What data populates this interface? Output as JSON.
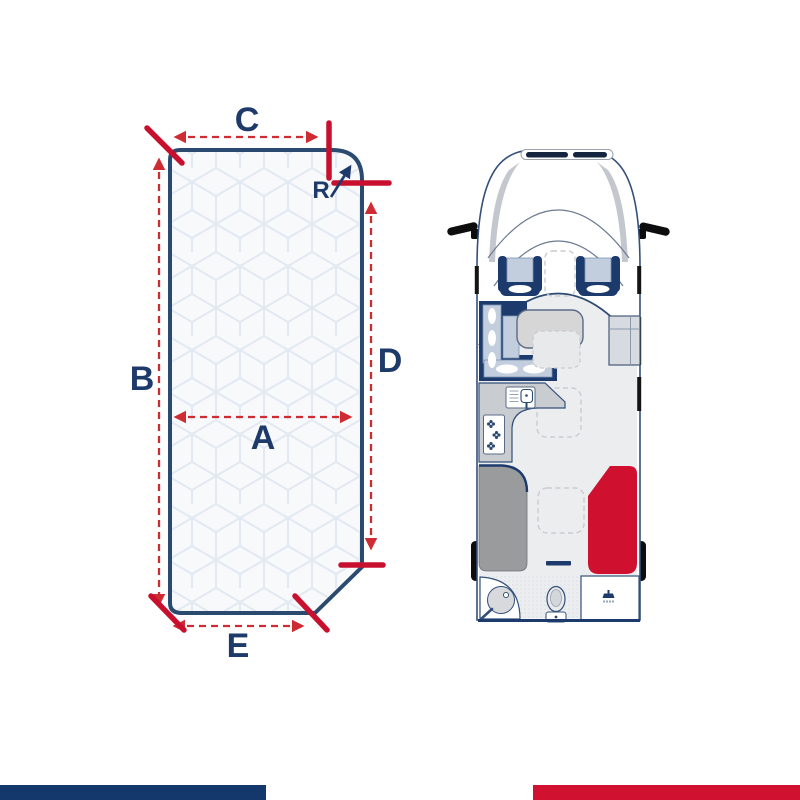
{
  "mattress_diagram": {
    "dimension_labels": {
      "a": "A",
      "b": "B",
      "c": "C",
      "d": "D",
      "e": "E",
      "radius": "R"
    },
    "colors": {
      "outline_navy": "#2b4a6f",
      "label_navy": "#1d3a6a",
      "tick_red": "#c8102e",
      "dimension_dash_red": "#cf2b33",
      "mattress_fill": "#f7f9fb",
      "quilt_pattern_line": "#e2e9f2"
    }
  },
  "floorplan": {
    "colors": {
      "highlighted_mattress_red": "#d0102f",
      "second_bed_gray": "#9a9b9d",
      "furniture_navy": "#1c3a6b",
      "cushion_blue": "#c2cedd",
      "floor_gray": "#ebedef",
      "counter_gray": "#c9ccd0",
      "body_outline": "#33507a"
    }
  },
  "footer": {
    "left_bar_color": "#14386b",
    "right_bar_color": "#d0112f"
  }
}
